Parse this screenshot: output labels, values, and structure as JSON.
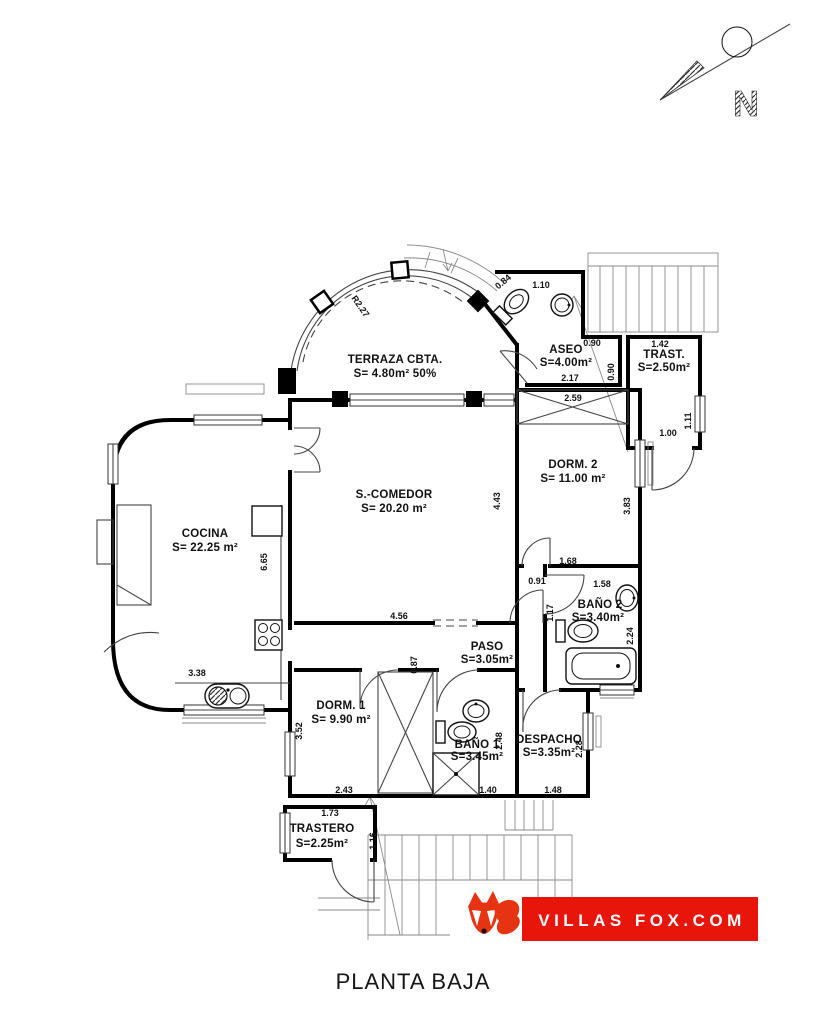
{
  "page_title": "PLANTA BAJA",
  "logo": {
    "text": "VILLAS FOX.COM",
    "brand_color": "#e8150b",
    "fox_color": "#e63312",
    "icon": "fox-icon"
  },
  "north_indicator": {
    "letter": "N",
    "icon": "north-arrow-icon"
  },
  "plan": {
    "rooms": [
      {
        "name": "TERRAZA CBTA.",
        "area": "S= 4.80m² 50%"
      },
      {
        "name": "ASEO",
        "area": "S=4.00m²"
      },
      {
        "name": "TRAST.",
        "area": "S=2.50m²"
      },
      {
        "name": "DORM. 2",
        "area": "S= 11.00 m²"
      },
      {
        "name": "S.-COMEDOR",
        "area": "S= 20.20 m²"
      },
      {
        "name": "COCINA",
        "area": "S= 22.25 m²"
      },
      {
        "name": "BAÑO 2",
        "area": "S=3.40m²"
      },
      {
        "name": "PASO",
        "area": "S=3.05m²"
      },
      {
        "name": "DORM. 1",
        "area": "S= 9.90 m²"
      },
      {
        "name": "BAÑO 1",
        "area": "S=3.45m²"
      },
      {
        "name": "DESPACHO",
        "area": "S=3.35m²"
      },
      {
        "name": "TRASTERO",
        "area": "S=2.25m²"
      }
    ],
    "radius_label": "R2.27",
    "dimensions": {
      "d084": "0.84",
      "d110": "1.10",
      "d090a": "0.90",
      "d090b": "0.90",
      "d217": "2.17",
      "d142": "1.42",
      "d111": "1.11",
      "d100": "1.00",
      "d259": "2.59",
      "d383": "3.83",
      "d443": "4.43",
      "d665": "6.65",
      "d168": "1.68",
      "d158": "1.58",
      "d091": "0.91",
      "d117": "1.17",
      "d224": "2.24",
      "d456": "4.56",
      "d087": "0.87",
      "d338": "3.38",
      "d352": "3.52",
      "d248": "2.48",
      "d228": "2.28",
      "d140": "1.40",
      "d148": "1.48",
      "d243": "2.43",
      "d173": "1.73",
      "d116": "1.16"
    }
  }
}
